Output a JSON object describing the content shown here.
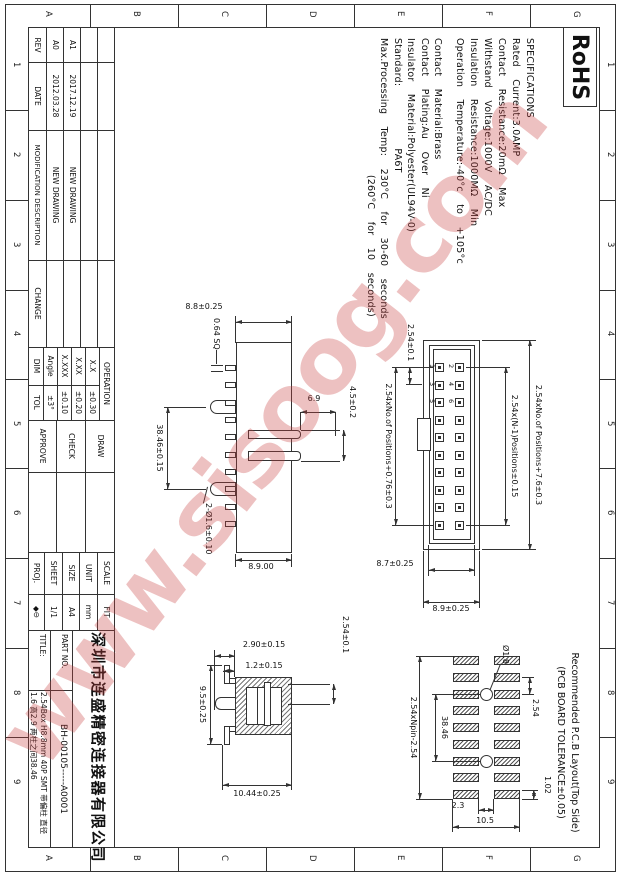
{
  "watermark": "www.sisoog.com",
  "frame": {
    "letters": [
      "G",
      "F",
      "E",
      "D",
      "C",
      "B",
      "A"
    ],
    "numbers": [
      "1",
      "2",
      "3",
      "4",
      "5",
      "6",
      "7",
      "8",
      "9"
    ]
  },
  "rohs_label": "RoHS",
  "specs": {
    "lines": [
      "SPECIFICATIONS",
      "Rated  Current:3.0AMP",
      "Contact  Resistance:20mΩ  Max",
      "Withstand  Voltage:1000V  AC/DC",
      "Insulation  Resistance:1000MΩ  Min",
      "Operation  Temperature:-40°c  to  +105°c",
      "Contact  Material:Brass",
      "Contact  Plating:Au  Over  Ni",
      "Insulator  Material:Polyester(UL94V-0)",
      "Standard:          PA6T",
      "Max.Processing  Temp:  230°C  for  30-60  seconds",
      "                      (260°C  for  10  seconds)"
    ]
  },
  "revision": {
    "headers": {
      "rev": "REV",
      "date": "DATE",
      "desc": "MODIFICATION DESCRIPTION",
      "change": "CHANGE"
    },
    "rows": [
      {
        "rev": "A1",
        "date": "2017.12.19",
        "desc": "NEW DRAWING"
      },
      {
        "rev": "A0",
        "date": "2012.03.28",
        "desc": "NEW DRAWING"
      }
    ]
  },
  "tolerance": {
    "title": "OPERATION",
    "rows": [
      {
        "dim": "X.X",
        "tol": "±0.30"
      },
      {
        "dim": "X.XX",
        "tol": "±0.20"
      },
      {
        "dim": "X.XXX",
        "tol": "±0.10"
      },
      {
        "dim": "Angle",
        "tol": "±3°"
      }
    ],
    "footer": {
      "dim": "DIM",
      "tol": "TOL"
    }
  },
  "approval": {
    "draw": "DRAW",
    "check": "CHECK",
    "approve": "APPROVE"
  },
  "info": {
    "scale_label": "SCALE",
    "scale_value": "FIT",
    "unit_label": "UNIT",
    "unit_value": "mm",
    "size_label": "SIZE",
    "size_value": "A4",
    "sheet_label": "SHEET",
    "sheet_value": "1/1",
    "proj_label": "PROJ.",
    "proj_symbol": "◆⊖"
  },
  "title_block": {
    "company": "深圳市连盛精密连接器有限公司",
    "part_no_label": "PART NO.",
    "part_no_value": "BH-00105-----A0001",
    "title_label": "TITLE:",
    "title_line1": "2.54Box H8.8mm 40P SMT 带偏柱 直径",
    "title_line2": "1.6 高2.9 两柱之间38.46"
  },
  "front_view": {
    "dim_height": "8.8±0.25",
    "dim_pin": "0.64 SQ",
    "dim_slot_depth": "6.9",
    "dim_slot_width": "4.5±0.2",
    "dim_peg_span": "38.46±0.15",
    "dim_peg": "2-Ø1.6±0.10",
    "dim_body": "8.9.00"
  },
  "top_view": {
    "dim_total": "2.54xNo.of Positions+7.6±0.3",
    "dim_pins": "2.54x(N-1)Positions±0.15",
    "dim_body": "2.54xNo.of Positions+0.76±0.3",
    "dim_pitch": "2.54±0.1",
    "dim_inner_height": "8.7±0.25",
    "dim_height": "8.9±0.25",
    "pin_numbers": [
      "1",
      "2",
      "3",
      "4",
      "5",
      "6"
    ]
  },
  "section_view": {
    "dim_pitch": "2.54±0.1",
    "dim_peg_h": "2.90±0.15",
    "dim_lead_h": "1.2±0.15",
    "dim_width": "9.5±0.25",
    "dim_total_h": "10.44±0.25"
  },
  "pcb_view": {
    "title_line1": "Recommended P.C.B Layout(Top Side)",
    "title_line2": "(PCB BOARD TOLERANCE±0.05)",
    "dim_pitch": "2.54",
    "dim_pad_w": "1.02",
    "dim_hole": "Ø1.8",
    "dim_hole_span": "38.46",
    "dim_total": "2.54xNpin-2.54",
    "dim_row_gap": "2.3",
    "dim_height": "10.5"
  }
}
